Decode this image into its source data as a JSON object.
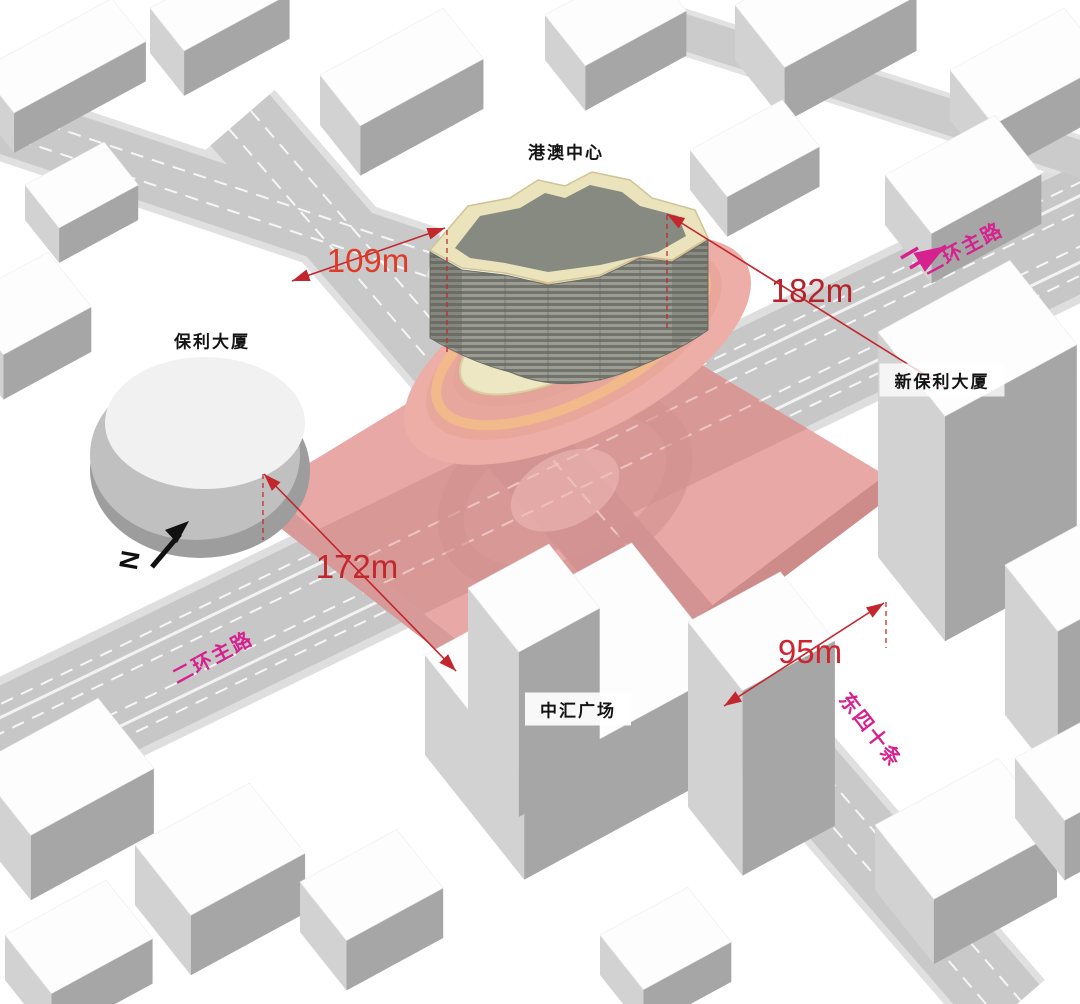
{
  "scene": {
    "site_labels": {
      "gangao": "港澳中心",
      "baoli": "保利大厦",
      "xinbaoli": "新保利大厦",
      "zhonghui": "中汇广场"
    },
    "dimensions": {
      "north": {
        "value": "109m",
        "color": "#e03a28"
      },
      "east": {
        "value": "182m",
        "color": "#b5222b"
      },
      "west": {
        "value": "172m",
        "color": "#c2272e"
      },
      "south": {
        "value": "95m",
        "color": "#cd2430"
      }
    },
    "roads": {
      "ring_top": "二环主路",
      "ring_bottom": "二环主路",
      "dongsishitiao": "东四十条"
    },
    "north_indicator": "N",
    "colors": {
      "site_overlay": "#e8a8a6",
      "dimension_red": "#c2272e",
      "road_label_magenta": "#d6218f",
      "podium_band_orange": "#f2ba8b",
      "building_parapet_cream": "#ebe3bc"
    }
  }
}
